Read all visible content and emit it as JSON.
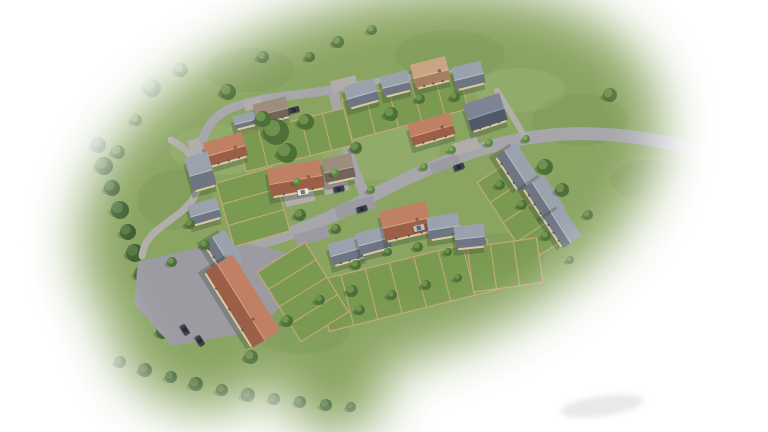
{
  "meta": {
    "alt": "Aerial CGI masterplan render of a new housing development surrounded by green fields, fading to white at the edges"
  },
  "palette": {
    "background": "#ffffff",
    "field": "#8aa562",
    "field_dark_blob": "rgba(70,100,45,0.09)",
    "field_light_blob": "rgba(214,226,184,0.10)",
    "road": "#a7a6ab",
    "path": "#b2afab",
    "court": "#9c9ba1",
    "drive": "#b0adaa",
    "lawn": "#7b9a51",
    "fence": "#c3a878",
    "wall": "#dccaa5",
    "window": "#565660",
    "shadow": "rgba(50,60,45,0.28)",
    "tree_shadow": "rgba(45,60,35,0.30)",
    "car_dark": "#3b404b",
    "car_white": "#e4e5e8",
    "car_silver": "#b9bcc3",
    "car_glass": "rgba(25,28,35,0.55)",
    "smudge": "#b9b7b4",
    "roofs": {
      "slate": {
        "light": "#9aa2ad",
        "dark": "#6e7684",
        "ridge": "#b9bfc8"
      },
      "dark": {
        "light": "#7d8595",
        "dark": "#525a6a",
        "ridge": "#97a0ae"
      },
      "terra": {
        "light": "#c08063",
        "dark": "#9b5f47",
        "ridge": "#d9a083"
      },
      "pale": {
        "light": "#c9a584",
        "dark": "#a67f63",
        "ridge": "#dcc0a0"
      },
      "brown": {
        "light": "#9c8d7c",
        "dark": "#71645a",
        "ridge": "#b5a794"
      }
    },
    "trees": [
      {
        "dark": "#4e7038",
        "light": "#6f9150"
      },
      {
        "dark": "#3f5e31",
        "light": "#547840"
      },
      {
        "dark": "#5d8542",
        "light": "#7ba75c"
      }
    ]
  },
  "scene": {
    "canvas": {
      "w": 768,
      "h": 432
    },
    "texture_dark": [
      [
        250,
        70,
        45,
        22
      ],
      [
        450,
        55,
        55,
        25
      ],
      [
        580,
        120,
        48,
        26
      ],
      [
        175,
        200,
        38,
        30
      ],
      [
        300,
        330,
        50,
        24
      ],
      [
        500,
        255,
        45,
        22
      ],
      [
        650,
        180,
        40,
        20
      ]
    ],
    "texture_light": [
      [
        380,
        150,
        60,
        30
      ],
      [
        220,
        150,
        50,
        25
      ],
      [
        520,
        90,
        45,
        22
      ]
    ],
    "hedges": [
      [
        [
          98,
          145,
          8
        ],
        [
          104,
          166,
          9
        ],
        [
          112,
          188,
          8
        ],
        [
          120,
          210,
          9
        ],
        [
          128,
          232,
          8
        ],
        [
          135,
          253,
          9
        ],
        [
          142,
          274,
          8
        ],
        [
          149,
          294,
          9
        ],
        [
          156,
          314,
          8
        ],
        [
          163,
          332,
          7
        ]
      ],
      [
        [
          120,
          362,
          6
        ],
        [
          145,
          370,
          7
        ],
        [
          171,
          377,
          6
        ],
        [
          196,
          384,
          7
        ],
        [
          222,
          390,
          6
        ],
        [
          248,
          395,
          7
        ],
        [
          274,
          399,
          6
        ],
        [
          300,
          402,
          6
        ],
        [
          326,
          405,
          6
        ],
        [
          351,
          407,
          5
        ]
      ]
    ],
    "roads": [
      {
        "d": "M 702,150 C 655,139 612,132 566,134 C 523,136 492,145 452,159",
        "w": 13,
        "c": "road"
      },
      {
        "d": "M 452,159 C 420,172 396,183 368,198 C 335,216 300,231 266,241 C 240,248 218,255 200,266",
        "w": 13,
        "c": "road"
      },
      {
        "d": "M 333,89 C 340,123 348,160 366,197",
        "w": 10,
        "c": "road"
      },
      {
        "d": "M 331,90 C 300,95 262,97 236,106 C 216,113 204,128 201,147 C 200,156 197,163 193,160",
        "w": 9,
        "c": "road"
      },
      {
        "d": "M 200,266 C 190,272 180,280 172,292",
        "w": 11,
        "c": "road"
      },
      {
        "d": "M 171,140 C 196,154 206,174 196,194 C 187,212 166,221 153,234 C 147,240 143,248 142,256",
        "w": 7,
        "c": "path"
      },
      {
        "d": "M 497,91 C 506,105 516,121 524,136",
        "w": 6,
        "c": "path"
      },
      {
        "d": "M 341,88 C 372,81 410,76 455,73",
        "w": 6,
        "c": "path"
      }
    ],
    "paved_polys": [
      {
        "pts": [
          [
            138,
            262
          ],
          [
            230,
            240
          ],
          [
            285,
            252
          ],
          [
            298,
            292
          ],
          [
            252,
            332
          ],
          [
            172,
            346
          ],
          [
            134,
            304
          ]
        ],
        "c": "court"
      }
    ],
    "paved_rects": [
      {
        "x": 355,
        "y": 207,
        "w": 40,
        "d": 13,
        "rot": -16,
        "c": "court"
      },
      {
        "x": 312,
        "y": 236,
        "w": 34,
        "d": 12,
        "rot": -16,
        "c": "court"
      },
      {
        "x": 445,
        "y": 164,
        "w": 30,
        "d": 11,
        "rot": -20,
        "c": "court"
      },
      {
        "x": 299,
        "y": 196,
        "w": 30,
        "d": 16,
        "rot": -12,
        "c": "drive"
      },
      {
        "x": 336,
        "y": 186,
        "w": 24,
        "d": 13,
        "rot": -12,
        "c": "drive"
      },
      {
        "x": 253,
        "y": 104,
        "w": 18,
        "d": 11,
        "rot": -14,
        "c": "drive"
      },
      {
        "x": 344,
        "y": 84,
        "w": 26,
        "d": 12,
        "rot": -14,
        "c": "drive"
      },
      {
        "x": 196,
        "y": 150,
        "w": 12,
        "d": 22,
        "rot": -16,
        "c": "drive"
      },
      {
        "x": 466,
        "y": 146,
        "w": 26,
        "d": 12,
        "rot": -18,
        "c": "drive"
      }
    ],
    "gardens": [
      {
        "x": 295,
        "y": 140,
        "w": 110,
        "d": 38,
        "rot": -14,
        "fences": 5
      },
      {
        "x": 405,
        "y": 105,
        "w": 120,
        "d": 40,
        "rot": -15,
        "fences": 5
      },
      {
        "x": 408,
        "y": 285,
        "w": 175,
        "d": 52,
        "rot": -14,
        "fences": 7
      },
      {
        "x": 522,
        "y": 210,
        "w": 95,
        "d": 45,
        "rot": 57,
        "fences": 4
      },
      {
        "x": 303,
        "y": 292,
        "w": 82,
        "d": 56,
        "rot": 58,
        "fences": 4
      },
      {
        "x": 505,
        "y": 265,
        "w": 70,
        "d": 45,
        "rot": -8,
        "fences": 3
      },
      {
        "x": 253,
        "y": 207,
        "w": 66,
        "d": 58,
        "rot": 74,
        "fences": 3
      }
    ],
    "houses": [
      {
        "x": 272,
        "y": 112,
        "w": 32,
        "d": 20,
        "rot": -14,
        "roof": "brown"
      },
      {
        "x": 245,
        "y": 122,
        "w": 20,
        "d": 13,
        "rot": -14,
        "roof": "slate"
      },
      {
        "x": 226,
        "y": 151,
        "w": 38,
        "d": 24,
        "rot": -16,
        "roof": "terra"
      },
      {
        "x": 201,
        "y": 173,
        "w": 22,
        "d": 34,
        "rot": -16,
        "roof": "slate"
      },
      {
        "x": 296,
        "y": 180,
        "w": 52,
        "d": 28,
        "rot": -10,
        "roof": "terra"
      },
      {
        "x": 339,
        "y": 170,
        "w": 28,
        "d": 24,
        "rot": -12,
        "roof": "brown"
      },
      {
        "x": 362,
        "y": 95,
        "w": 30,
        "d": 22,
        "rot": -16,
        "roof": "slate"
      },
      {
        "x": 396,
        "y": 85,
        "w": 26,
        "d": 20,
        "rot": -14,
        "roof": "slate"
      },
      {
        "x": 431,
        "y": 74,
        "w": 34,
        "d": 24,
        "rot": -14,
        "roof": "pale"
      },
      {
        "x": 469,
        "y": 77,
        "w": 28,
        "d": 22,
        "rot": -14,
        "roof": "slate"
      },
      {
        "x": 432,
        "y": 131,
        "w": 42,
        "d": 22,
        "rot": -16,
        "roof": "terra"
      },
      {
        "x": 486,
        "y": 114,
        "w": 36,
        "d": 28,
        "rot": -18,
        "roof": "dark"
      },
      {
        "x": 516,
        "y": 168,
        "w": 40,
        "d": 24,
        "rot": 57,
        "roof": "slate"
      },
      {
        "x": 543,
        "y": 199,
        "w": 38,
        "d": 24,
        "rot": 57,
        "roof": "slate"
      },
      {
        "x": 561,
        "y": 228,
        "w": 34,
        "d": 22,
        "rot": 57,
        "roof": "slate"
      },
      {
        "x": 347,
        "y": 252,
        "w": 32,
        "d": 22,
        "rot": -16,
        "roof": "slate"
      },
      {
        "x": 374,
        "y": 242,
        "w": 30,
        "d": 22,
        "rot": -15,
        "roof": "slate"
      },
      {
        "x": 406,
        "y": 223,
        "w": 46,
        "d": 30,
        "rot": -13,
        "roof": "terra"
      },
      {
        "x": 444,
        "y": 228,
        "w": 30,
        "d": 22,
        "rot": -9,
        "roof": "slate"
      },
      {
        "x": 470,
        "y": 238,
        "w": 28,
        "d": 22,
        "rot": -6,
        "roof": "slate"
      },
      {
        "x": 222,
        "y": 252,
        "w": 34,
        "d": 24,
        "rot": 58,
        "roof": "slate"
      },
      {
        "x": 241,
        "y": 302,
        "w": 88,
        "d": 32,
        "rot": 58,
        "roof": "terra"
      },
      {
        "x": 205,
        "y": 213,
        "w": 28,
        "d": 20,
        "rot": -16,
        "roof": "slate"
      }
    ],
    "trees": [
      [
        152,
        88,
        9,
        0
      ],
      [
        181,
        70,
        7,
        0
      ],
      [
        228,
        92,
        8,
        0
      ],
      [
        263,
        57,
        6,
        0
      ],
      [
        136,
        120,
        6,
        0
      ],
      [
        118,
        152,
        7,
        0
      ],
      [
        310,
        57,
        5,
        0
      ],
      [
        338,
        42,
        6,
        0
      ],
      [
        372,
        30,
        5,
        0
      ],
      [
        610,
        95,
        7,
        0
      ],
      [
        545,
        167,
        8,
        0
      ],
      [
        562,
        190,
        7,
        0
      ],
      [
        588,
        215,
        5,
        0
      ],
      [
        276,
        132,
        13,
        0
      ],
      [
        287,
        153,
        10,
        0
      ],
      [
        263,
        119,
        8,
        0
      ],
      [
        306,
        122,
        8,
        0
      ],
      [
        391,
        114,
        7,
        0
      ],
      [
        356,
        148,
        6,
        0
      ],
      [
        420,
        99,
        5,
        0
      ],
      [
        455,
        97,
        5,
        0
      ],
      [
        300,
        215,
        6,
        0
      ],
      [
        336,
        229,
        5,
        0
      ],
      [
        356,
        265,
        5,
        0
      ],
      [
        388,
        252,
        4,
        0
      ],
      [
        418,
        247,
        5,
        0
      ],
      [
        448,
        252,
        4,
        0
      ],
      [
        320,
        300,
        5,
        0
      ],
      [
        352,
        291,
        6,
        0
      ],
      [
        287,
        321,
        6,
        0
      ],
      [
        251,
        357,
        7,
        0
      ],
      [
        360,
        310,
        5,
        0
      ],
      [
        392,
        295,
        5,
        0
      ],
      [
        426,
        285,
        5,
        0
      ],
      [
        458,
        278,
        4,
        0
      ],
      [
        190,
        224,
        5,
        0
      ],
      [
        205,
        245,
        5,
        0
      ],
      [
        172,
        262,
        5,
        0
      ],
      [
        500,
        185,
        5,
        0
      ],
      [
        522,
        205,
        5,
        0
      ],
      [
        546,
        236,
        5,
        0
      ],
      [
        570,
        260,
        4,
        0
      ],
      [
        297,
        182,
        4,
        2
      ],
      [
        335,
        173,
        4,
        2
      ],
      [
        371,
        190,
        4,
        2
      ],
      [
        424,
        167,
        4,
        2
      ],
      [
        452,
        150,
        4,
        2
      ],
      [
        489,
        143,
        4,
        2
      ],
      [
        526,
        139,
        4,
        2
      ]
    ],
    "cars": [
      [
        303,
        192,
        -12,
        "white"
      ],
      [
        339,
        189,
        -12,
        "dark"
      ],
      [
        362,
        209,
        -16,
        "dark"
      ],
      [
        419,
        228,
        -14,
        "silver"
      ],
      [
        459,
        167,
        -20,
        "dark"
      ],
      [
        294,
        110,
        -14,
        "dark"
      ],
      [
        185,
        330,
        58,
        "dark"
      ],
      [
        200,
        341,
        58,
        "dark"
      ]
    ],
    "smudge": {
      "x": 602,
      "y": 406,
      "rx": 42,
      "ry": 10,
      "rot": -8,
      "opacity": 0.3
    },
    "vignette": {
      "blur": 26,
      "ellipse": {
        "cx": 370,
        "cy": 185,
        "rx": 300,
        "ry": 180,
        "rot": -18
      },
      "blobs": [
        [
          205,
          315,
          95
        ],
        [
          335,
          385,
          50
        ]
      ]
    }
  }
}
